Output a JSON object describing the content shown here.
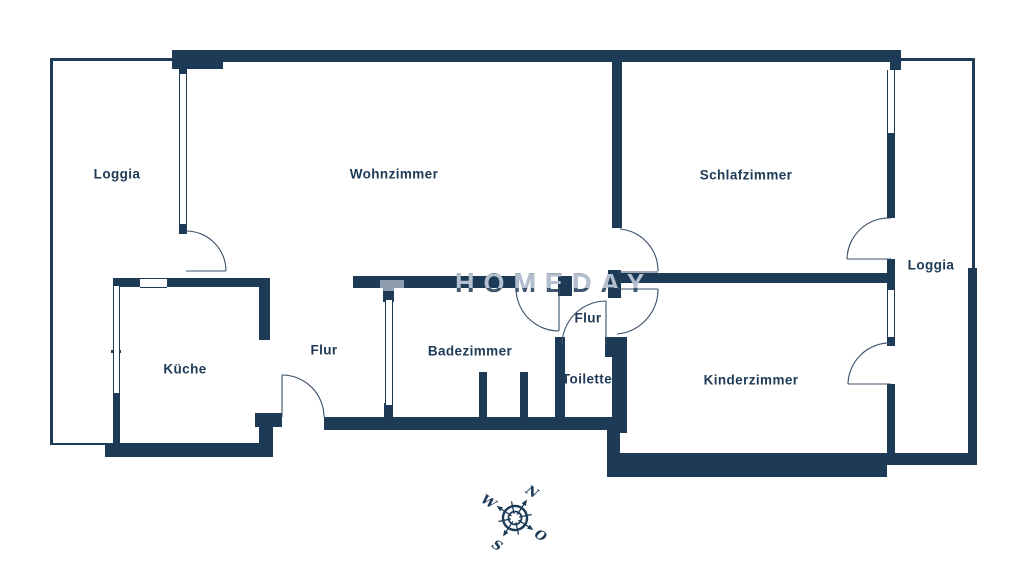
{
  "meta": {
    "title": "Grundriss Wohnung",
    "type": "floor-plan"
  },
  "colors": {
    "wall": "#1d3a57",
    "background": "#ffffff",
    "watermark_light": "#b4bfcf",
    "watermark_dark": "#1d3a57"
  },
  "watermark": {
    "text": "HOMEDAY"
  },
  "rooms": [
    {
      "id": "loggia-left",
      "label": "Loggia"
    },
    {
      "id": "wohnzimmer",
      "label": "Wohnzimmer"
    },
    {
      "id": "schlafzimmer",
      "label": "Schlafzimmer"
    },
    {
      "id": "loggia-right",
      "label": "Loggia"
    },
    {
      "id": "kueche",
      "label": "Küche"
    },
    {
      "id": "flur-main",
      "label": "Flur"
    },
    {
      "id": "badezimmer",
      "label": "Badezimmer"
    },
    {
      "id": "flur-small",
      "label": "Flur"
    },
    {
      "id": "toilette",
      "label": "Toilette"
    },
    {
      "id": "kinderzimmer",
      "label": "Kinderzimmer"
    }
  ],
  "compass": {
    "north": "N",
    "east": "O",
    "south": "S",
    "west": "W",
    "rotation_deg": 33
  }
}
